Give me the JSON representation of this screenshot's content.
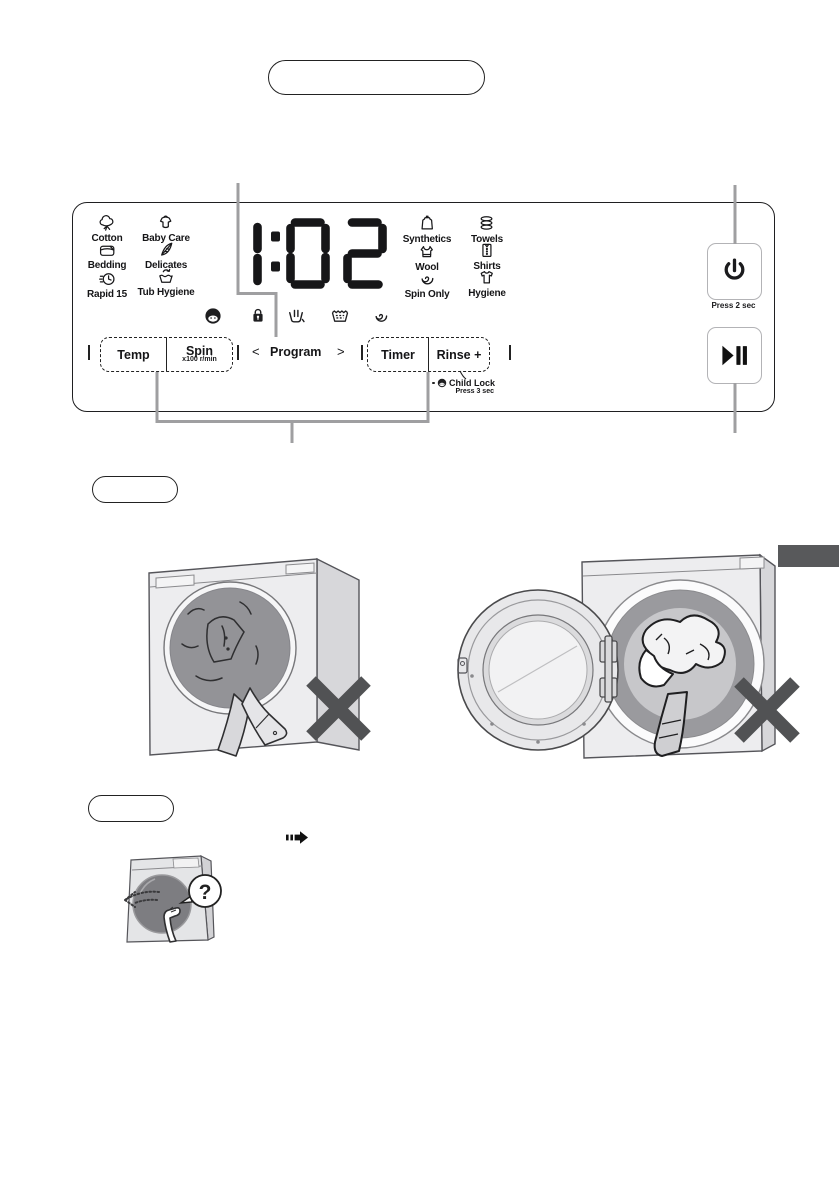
{
  "colors": {
    "ink": "#161618",
    "callout_gray": "#9f9fa1",
    "x_mark": "#515254",
    "side_tab": "#58595b"
  },
  "labels": {
    "top_box": "",
    "note_box_1": "",
    "note_box_2": ""
  },
  "panel": {
    "display_time": "1:02",
    "programs": [
      {
        "label": "Cotton",
        "icon": "cotton-icon"
      },
      {
        "label": "Baby Care",
        "icon": "baby-care-icon"
      },
      {
        "label": "Bedding",
        "icon": "bedding-icon"
      },
      {
        "label": "Delicates",
        "icon": "delicates-icon"
      },
      {
        "label": "Rapid 15",
        "icon": "rapid-15-icon"
      },
      {
        "label": "Tub Hygiene",
        "icon": "tub-hygiene-icon"
      },
      {
        "label": "Synthetics",
        "icon": "synthetics-icon"
      },
      {
        "label": "Towels",
        "icon": "towels-icon"
      },
      {
        "label": "Wool",
        "icon": "wool-icon"
      },
      {
        "label": "Shirts",
        "icon": "shirts-icon"
      },
      {
        "label": "Spin Only",
        "icon": "spin-only-icon"
      },
      {
        "label": "Hygiene",
        "icon": "hygiene-icon"
      }
    ],
    "status_icons": [
      "child-face-icon",
      "door-lock-icon",
      "prewash-tub-icon",
      "washtub-icon",
      "spin-spiral-icon"
    ],
    "controls": {
      "temp": "Temp",
      "spin": "Spin",
      "spin_unit": "x100 r/min",
      "program_prev": "<",
      "program": "Program",
      "program_next": ">",
      "timer": "Timer",
      "rinse": "Rinse +"
    },
    "child_lock": {
      "label": "Child Lock",
      "hint": "Press 3 sec"
    },
    "power": {
      "hint": "Press 2 sec"
    }
  },
  "illustrations": {
    "question_mark": "?"
  }
}
